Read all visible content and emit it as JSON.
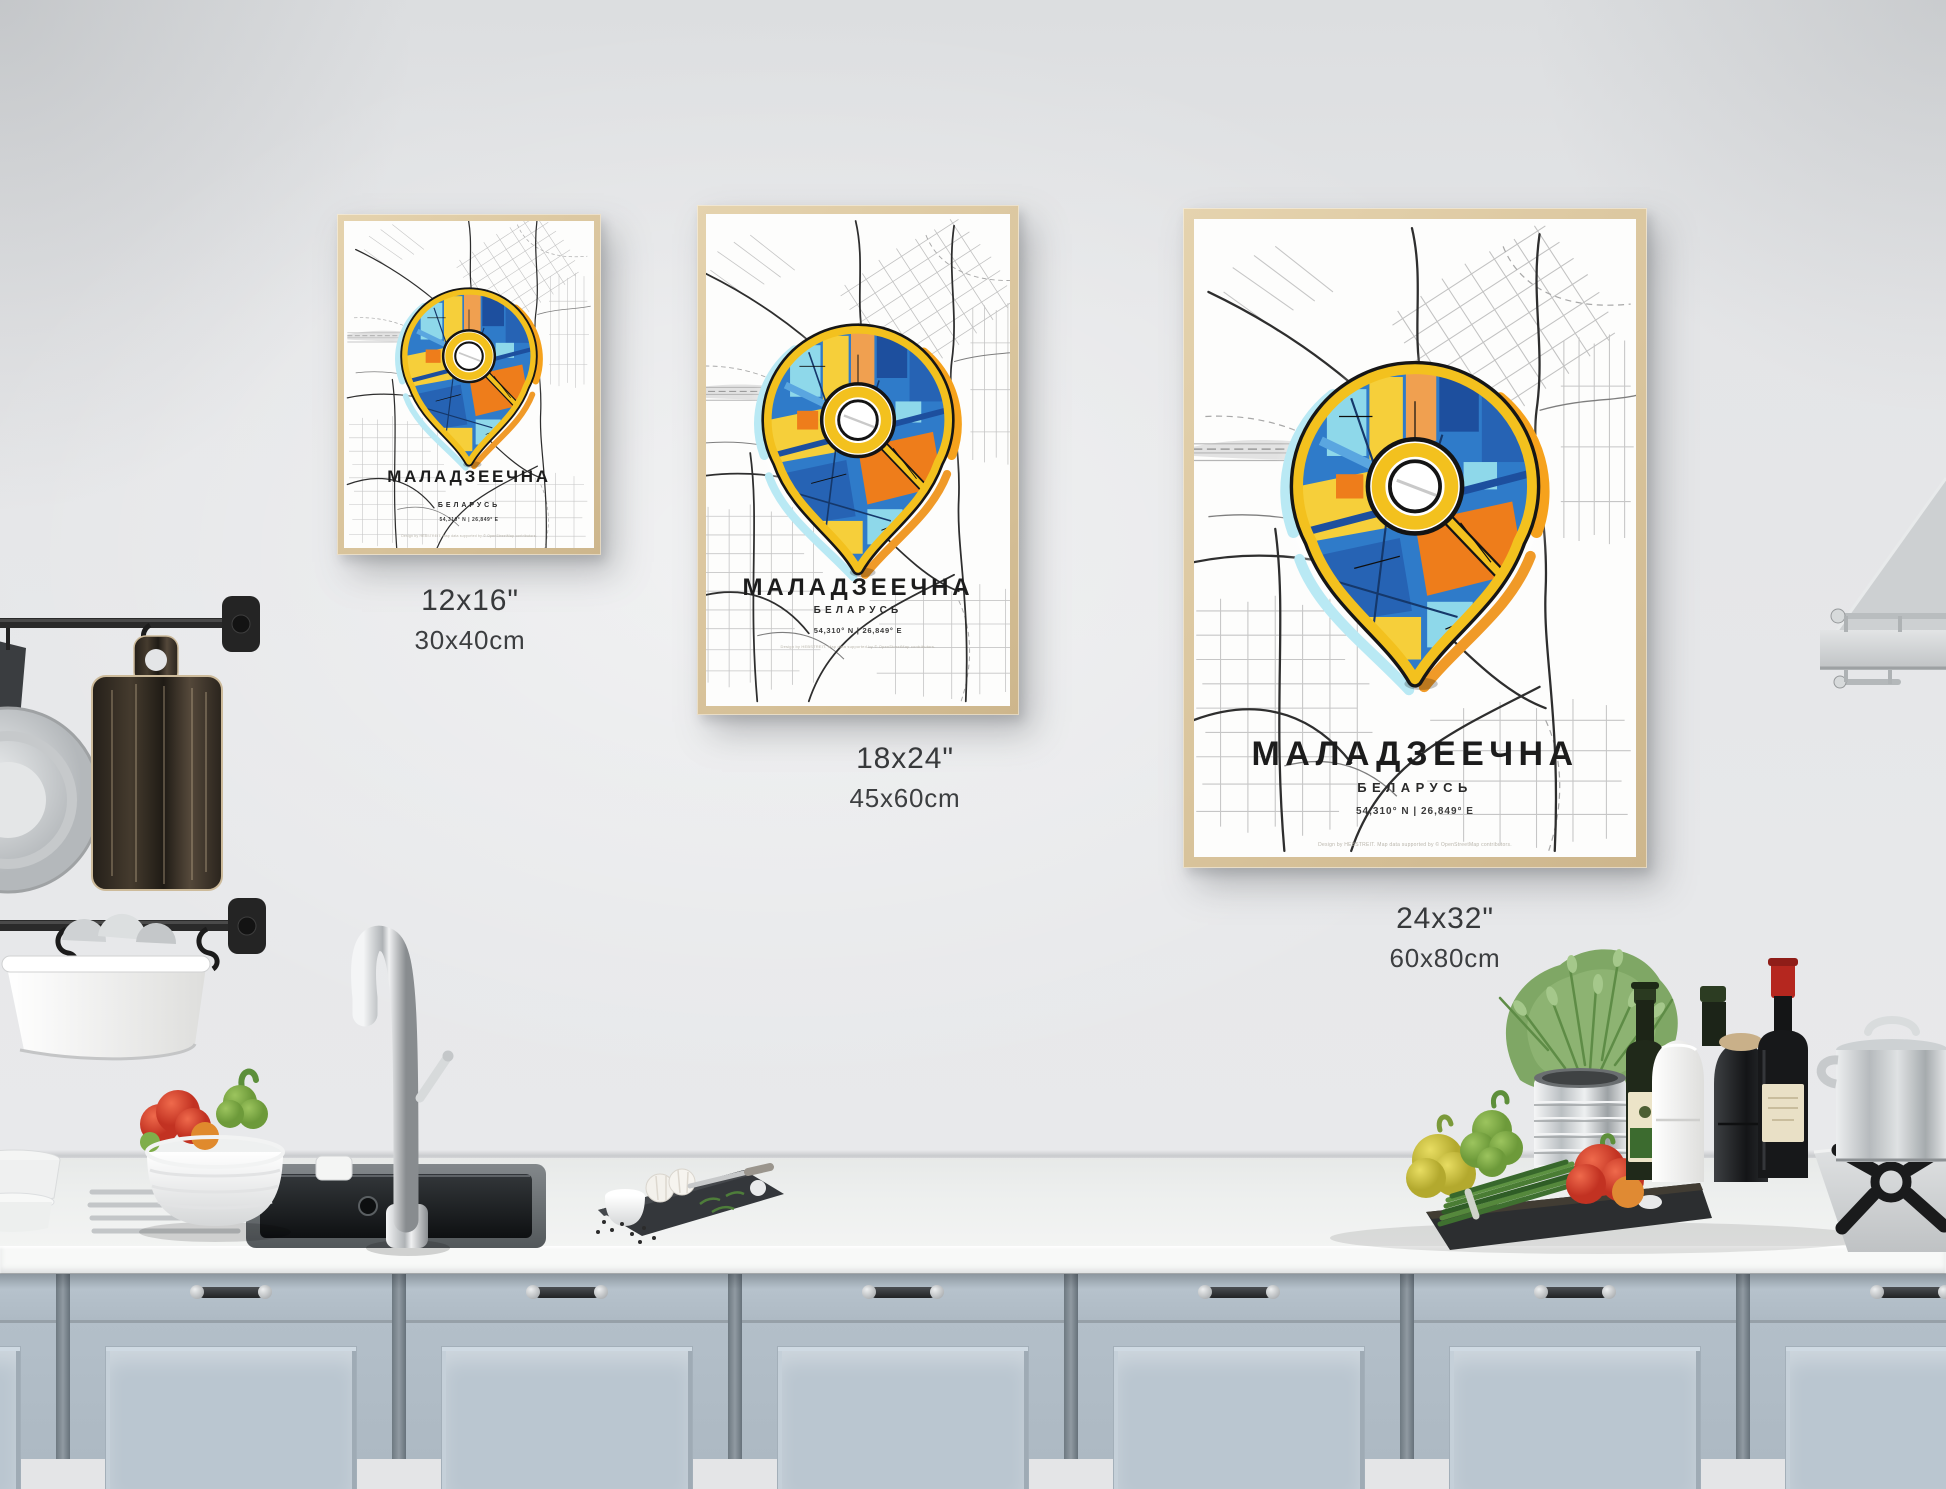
{
  "posters": [
    {
      "title": "МАЛАДЗЕЕЧНА",
      "subtitle": "БЕЛАРУСЬ",
      "coordinates": "54,310° N | 26,849° E",
      "credit": "Design by HEBSTREIT. Map data supported by © OpenStreetMap contributors.",
      "size_inches": "12x16\"",
      "size_metric": "30x40cm"
    },
    {
      "title": "МАЛАДЗЕЕЧНА",
      "subtitle": "БЕЛАРУСЬ",
      "coordinates": "54,310° N | 26,849° E",
      "credit": "Design by HEBSTREIT. Map data supported by © OpenStreetMap contributors.",
      "size_inches": "18x24\"",
      "size_metric": "45x60cm"
    },
    {
      "title": "МАЛАДЗЕЕЧНА",
      "subtitle": "БЕЛАРУСЬ",
      "coordinates": "54,310° N | 26,849° E",
      "credit": "Design by HEBSTREIT. Map data supported by © OpenStreetMap contributors.",
      "size_inches": "24x32\"",
      "size_metric": "60x80cm"
    }
  ],
  "colors": {
    "pin_yellow": "#f3c11e",
    "pin_orange": "#ee7d1b",
    "pin_blue": "#2f7bc9",
    "pin_navy": "#1d4f9e",
    "pin_cyan": "#8ed8ea",
    "frame_wood": "#dcc8a3",
    "wall": "#e4e5e7",
    "cabinet_blue_gray": "#b0bdc7"
  }
}
